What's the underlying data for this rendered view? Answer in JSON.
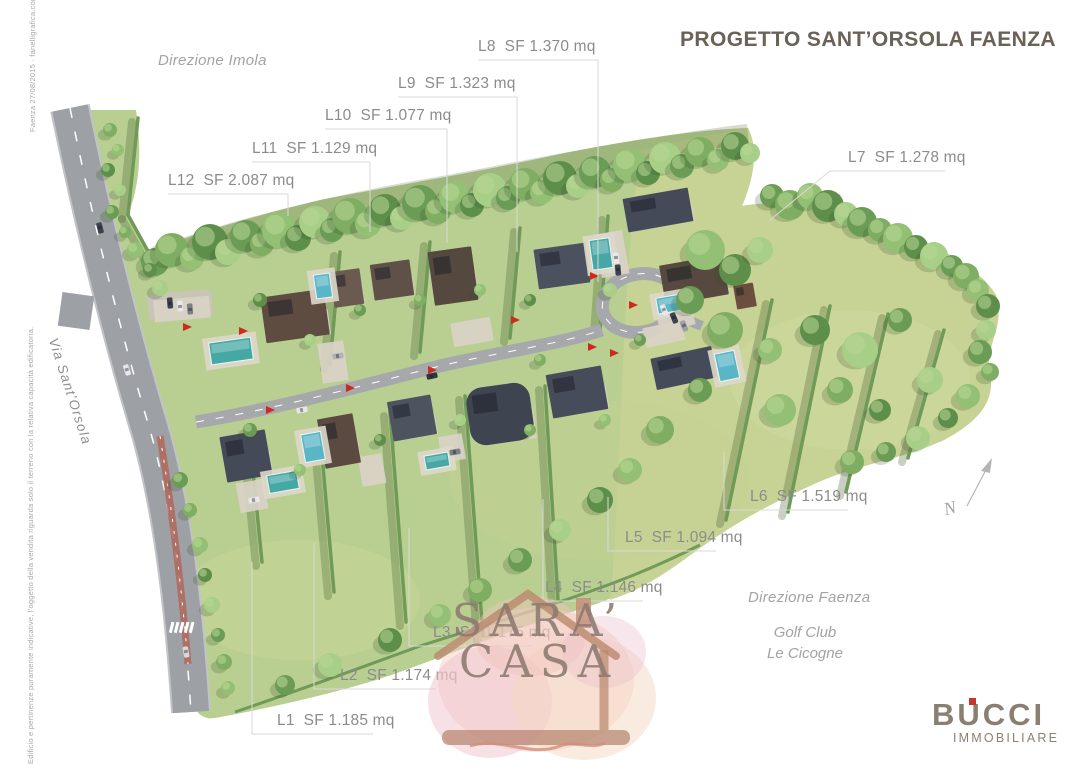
{
  "title": "PROGETTO SANT’ORSOLA FAENZA",
  "annotations": {
    "direction_top": "Direzione Imola",
    "direction_bottom": "Direzione Faenza",
    "golf_club_line1": "Golf Club",
    "golf_club_line2": "Le Cicogne",
    "road_name": "Via Sant’Orsola",
    "north_label": "N",
    "credit_note": "Faenza 27/08/2015 · fanelligrafica.com",
    "disclaimer": "Edificio e pertinenze puramente indicative, l’oggetto della vendita riguarda solo il terreno con la relativa capacità edificatoria."
  },
  "lots": [
    {
      "id": "L1",
      "area": "SF 1.185 mq"
    },
    {
      "id": "L2",
      "area": "SF 1.174 mq"
    },
    {
      "id": "L3",
      "area": "SF 1.175 mq"
    },
    {
      "id": "L4",
      "area": "SF 1.146 mq"
    },
    {
      "id": "L5",
      "area": "SF 1.094 mq"
    },
    {
      "id": "L6",
      "area": "SF 1.519 mq"
    },
    {
      "id": "L7",
      "area": "SF 1.278 mq"
    },
    {
      "id": "L8",
      "area": "SF 1.370 mq"
    },
    {
      "id": "L9",
      "area": "SF 1.323 mq"
    },
    {
      "id": "L10",
      "area": "SF 1.077 mq"
    },
    {
      "id": "L11",
      "area": "SF 1.129 mq"
    },
    {
      "id": "L12",
      "area": "SF 2.087 mq"
    }
  ],
  "watermark": {
    "line1": "SARA’",
    "line2": "CASA"
  },
  "logo": {
    "name": "BUCCI",
    "subtitle": "IMMOBILIARE"
  },
  "colors": {
    "title_text": "#6b6156",
    "label_text": "#8c8c8c",
    "site_green": "#b9cf92",
    "meadow_green": "#c6d395",
    "road_gray": "#9da0a5",
    "pool_teal": "#4fb0ac",
    "marker_red": "#cc2a1e",
    "logo_taupe": "#8a8072",
    "logo_red": "#c0392b"
  }
}
